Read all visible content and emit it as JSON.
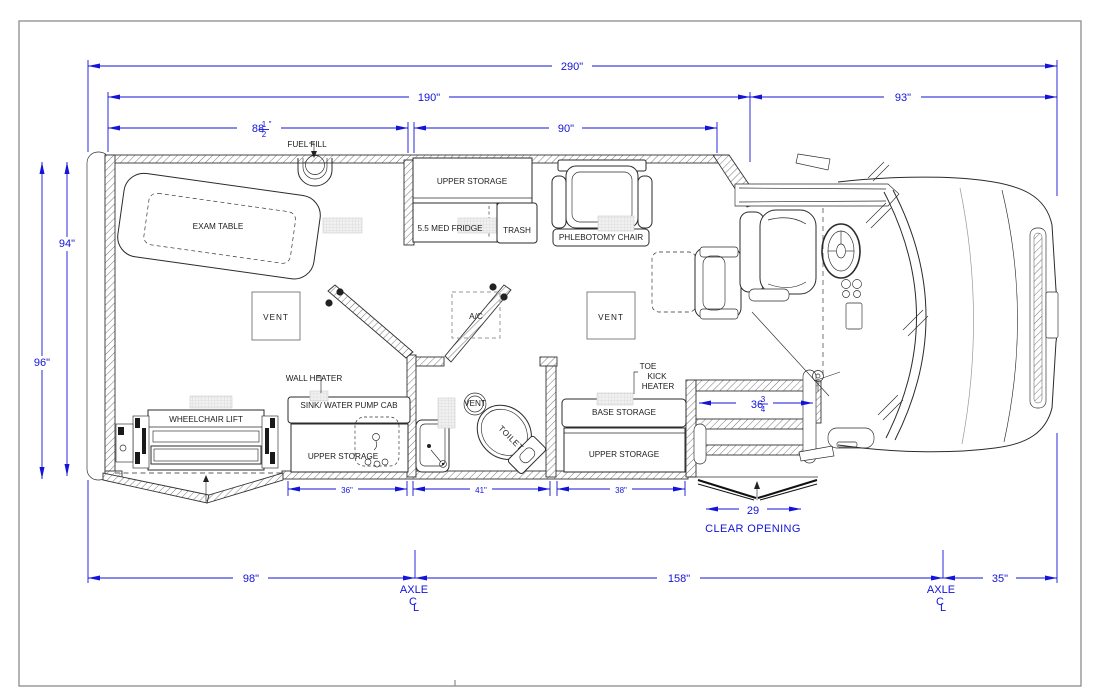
{
  "dims": {
    "d290": "290\"",
    "d190": "190\"",
    "d93": "93\"",
    "d88w": "88",
    "d88n": "1",
    "d88d": "2",
    "d88s": "\"",
    "d90": "90\"",
    "d94": "94\"",
    "d96": "96\"",
    "d36": "36\"",
    "d41": "41\"",
    "d38": "38\"",
    "d36qw": "36",
    "d36qn": "3",
    "d36qd": "4",
    "d29": "29",
    "clear_opening": "CLEAR OPENING",
    "d98": "98\"",
    "d158": "158\"",
    "d35": "35\"",
    "axle": "AXLE",
    "cl_c": "C",
    "cl_l": "L"
  },
  "labels": {
    "fuel_fill": "FUEL FILL",
    "exam_table": "EXAM TABLE",
    "upper_storage_top": "UPPER STORAGE",
    "med_fridge": "5.5 MED FRIDGE",
    "trash": "TRASH",
    "phlebotomy_chair": "PHLEBOTOMY CHAIR",
    "vent_left": "VENT",
    "ac": "A/C",
    "vent_right": "VENT",
    "wall_heater": "WALL HEATER",
    "sink_cab": "SINK/ WATER PUMP CAB",
    "upper_storage_sink": "UPPER STORAGE",
    "wheelchair_lift": "WHEELCHAIR LIFT",
    "toilet": "TOILET",
    "vent_small": "VENT",
    "base_storage": "BASE STORAGE",
    "upper_storage_right": "UPPER STORAGE",
    "toe_kick_1": "TOE",
    "toe_kick_2": "KICK",
    "toe_kick_3": "HEATER"
  },
  "colors": {
    "dimension": "#1313d9",
    "line": "#2b2b2b",
    "grille_fill": "#f1f1f1"
  }
}
